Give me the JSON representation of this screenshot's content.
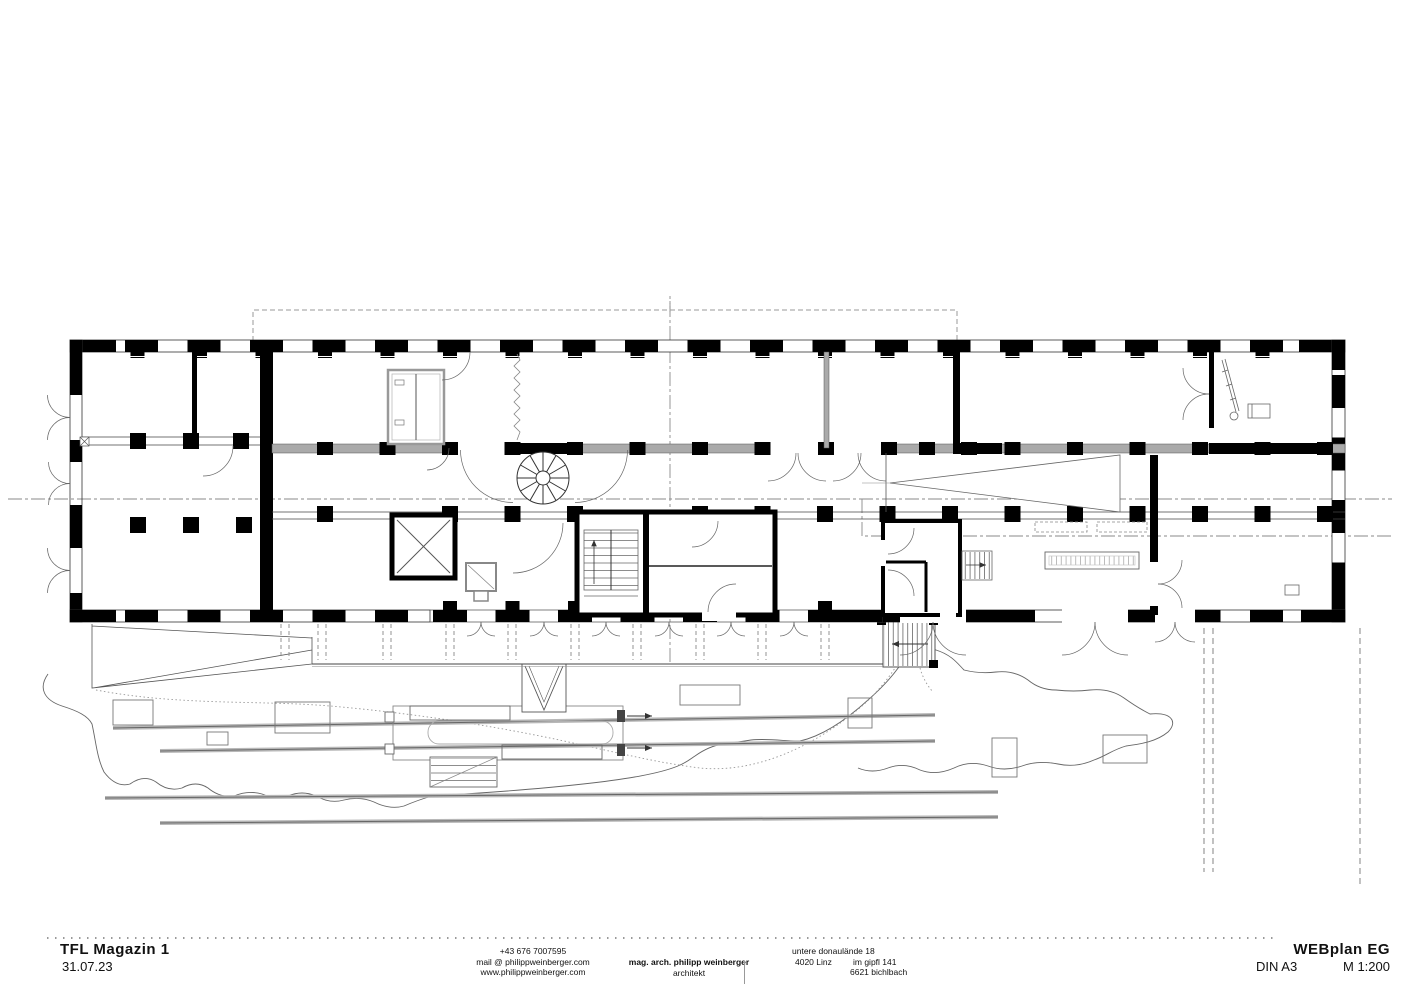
{
  "colors": {
    "paper": "#ffffff",
    "ink": "#000000",
    "wall_hatch_gray": "#aaaaaa",
    "track_gray": "#b8b8b8"
  },
  "title_block": {
    "project_name": "TFL Magazin 1",
    "date": "31.07.23",
    "contact": {
      "phone": "+43 676 7007595",
      "email": "mail @ philippweinberger.com",
      "website": "www.philippweinberger.com"
    },
    "architect": {
      "name": "mag. arch. philipp weinberger",
      "role": "architekt"
    },
    "address": {
      "office_street": "untere donaulände 18",
      "office_city": "4020 Linz",
      "studio_street": "im gipfl 141",
      "studio_city": "6621 bichlbach"
    },
    "plan": {
      "name": "WEBplan EG",
      "format": "DIN A3",
      "scale": "M 1:200"
    }
  }
}
